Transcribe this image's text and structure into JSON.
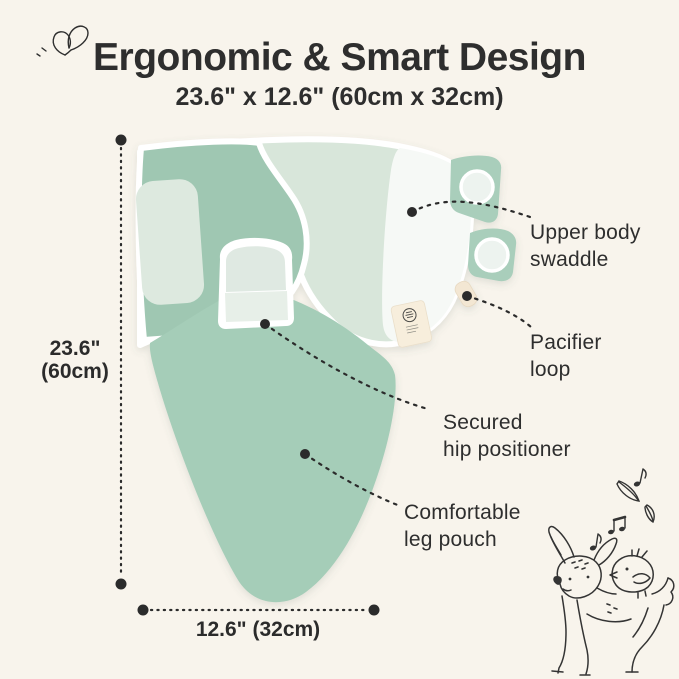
{
  "header": {
    "title": "Ergonomic & Smart Design",
    "subtitle": "23.6\" x 12.6\" (60cm x 32cm)"
  },
  "dimensions": {
    "height": {
      "lines": [
        "23.6\"",
        "(60cm)"
      ]
    },
    "width": {
      "label": "12.6\" (32cm)"
    }
  },
  "callouts": [
    {
      "lines": [
        "Upper body",
        "swaddle"
      ]
    },
    {
      "lines": [
        "Pacifier",
        "loop"
      ]
    },
    {
      "lines": [
        "Secured",
        "hip positioner"
      ]
    },
    {
      "lines": [
        "Comfortable",
        "leg pouch"
      ]
    }
  ],
  "colors": {
    "background": "#f8f4ec",
    "text": "#2e2e2e",
    "swaddle_wing_mint": "#9fc7b2",
    "swaddle_upper_mint": "#d8e6da",
    "swaddle_pouch_mint": "#a5cdb8",
    "swaddle_trim_white": "#ffffff",
    "velcro_patch": "#dde9df",
    "tab_mint": "#a9cebb",
    "tag_cream": "#f7eedc",
    "pacifier_loop_cream": "#f3e7d3",
    "doodle_ink": "#343434"
  },
  "decor": {
    "butterfly_icon": "butterfly-doodle",
    "deer_icon": "fawn-with-bird-doodle",
    "music_notes_icon": "music-notes-and-feathers"
  }
}
